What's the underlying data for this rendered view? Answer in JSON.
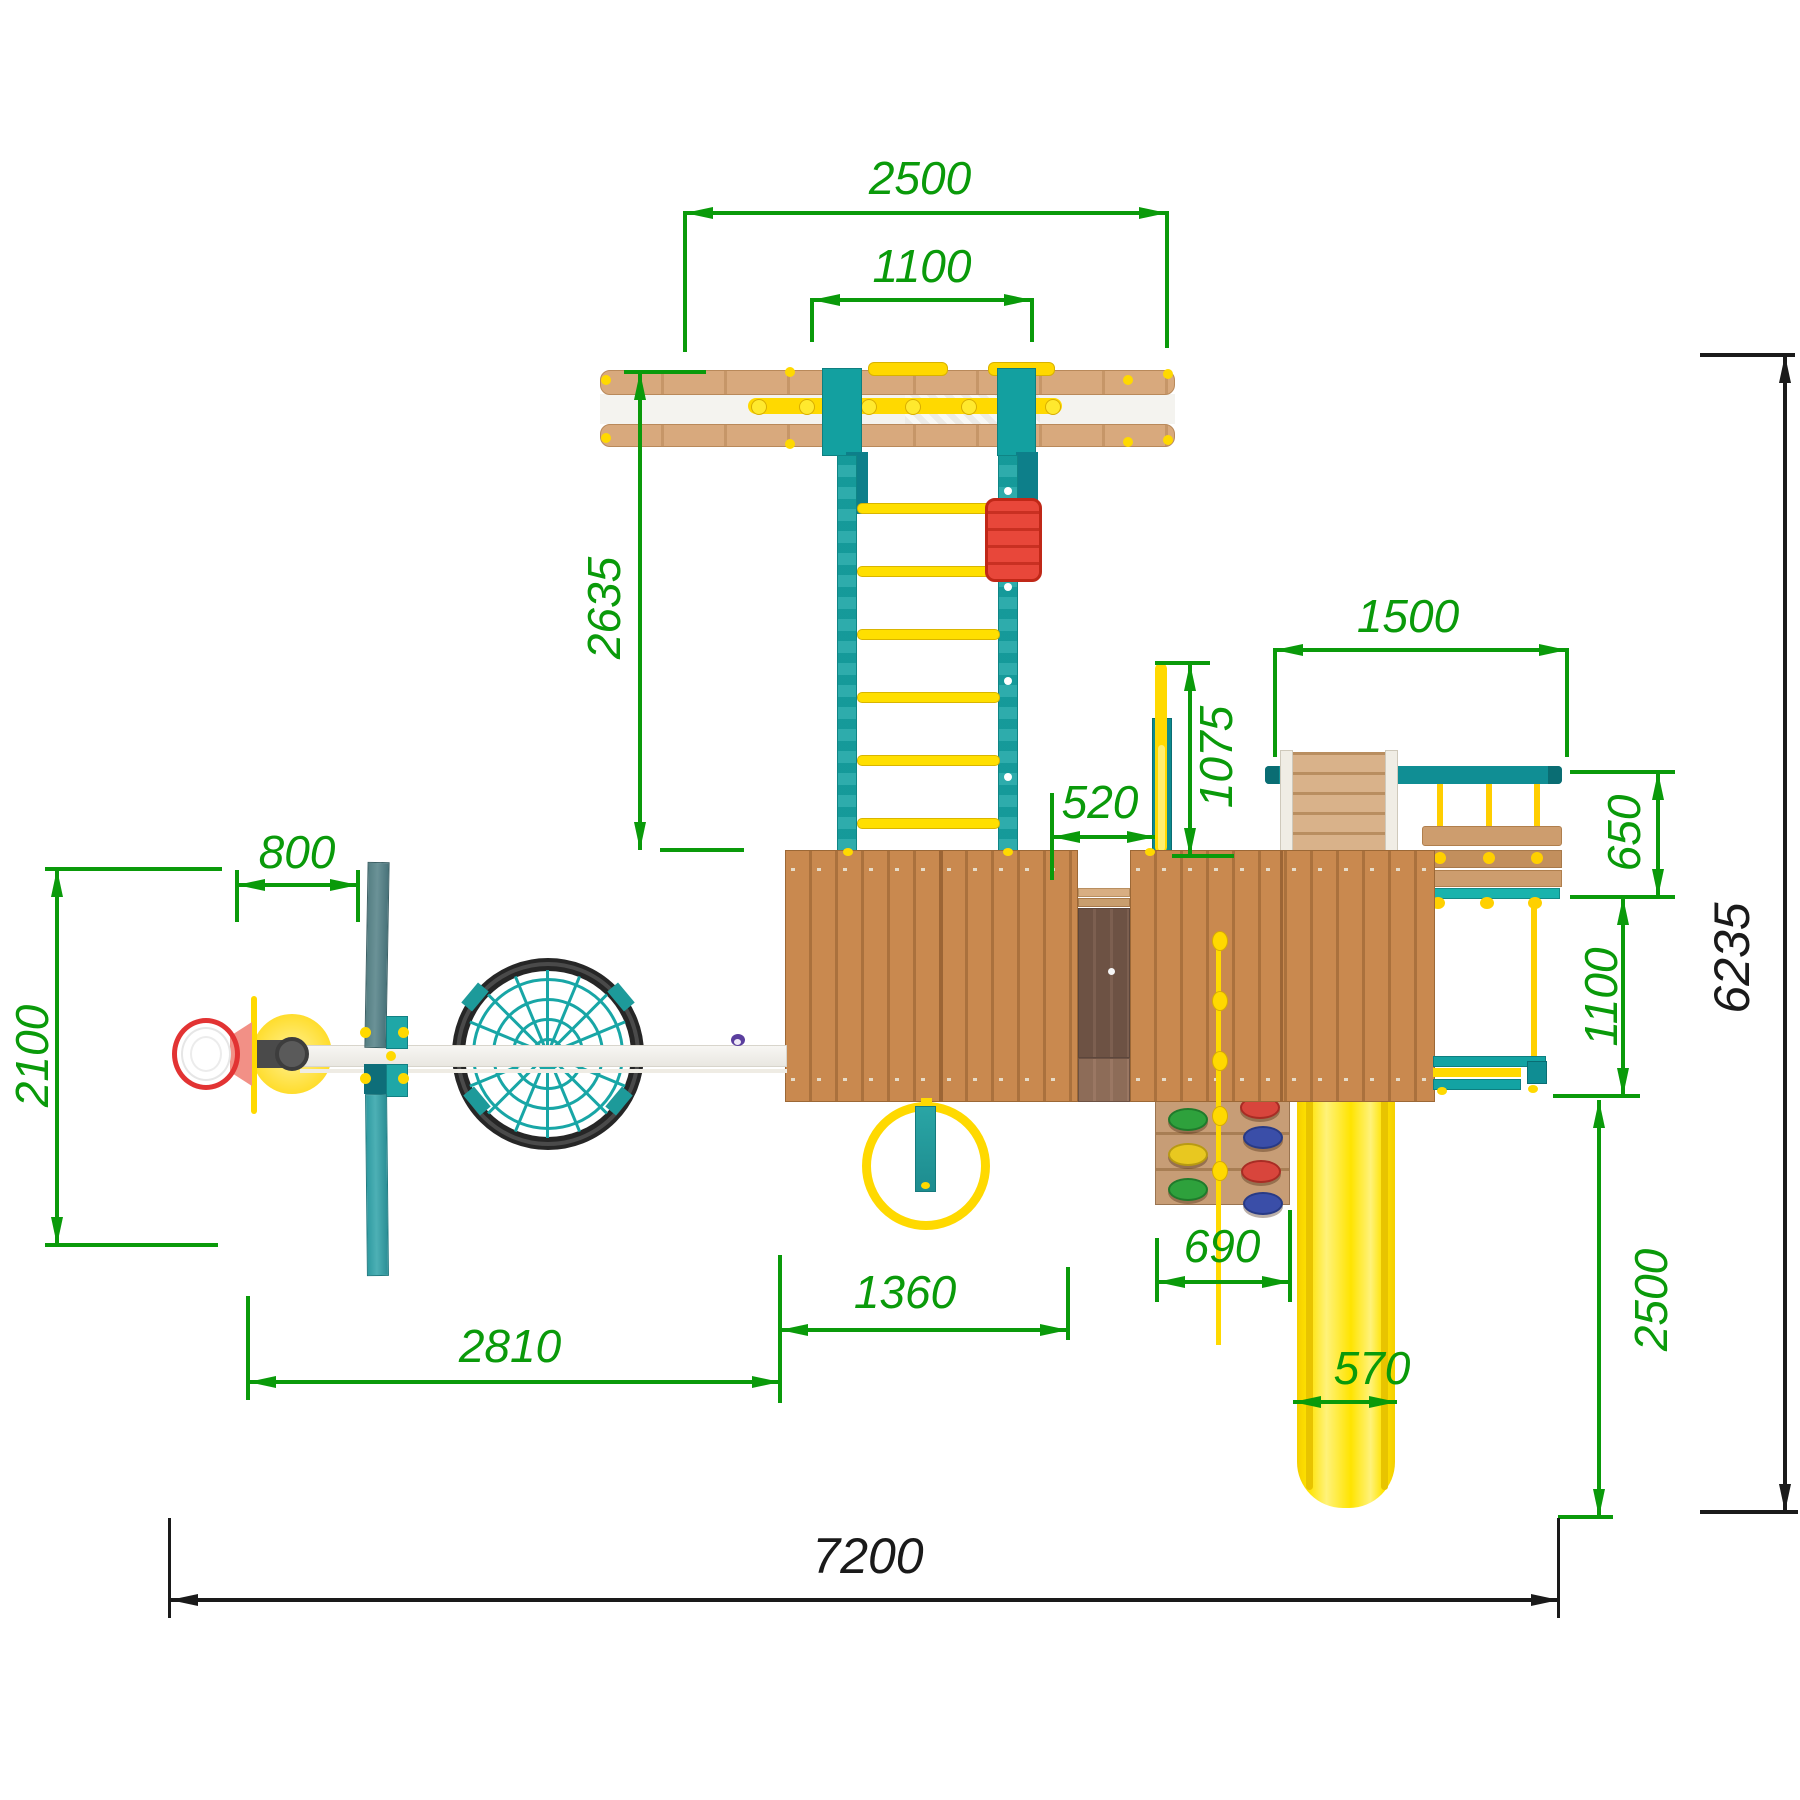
{
  "drawing": {
    "kind": "playground-top-view-plan",
    "units": "mm",
    "detail_dimension_color": "#0a9a0a",
    "overall_dimension_color": "#1a1a1a",
    "dimensions": {
      "top_beam_length": {
        "value": "2500"
      },
      "monkey_bar_span": {
        "value": "1100"
      },
      "ladder_length": {
        "value": "2635"
      },
      "basketball_offset": {
        "value": "800"
      },
      "left_zone_depth": {
        "value": "2100"
      },
      "swing_beam_span": {
        "value": "2810"
      },
      "ring_swing_span": {
        "value": "1360"
      },
      "bridge_gap": {
        "value": "520"
      },
      "pole_offset": {
        "value": "1075"
      },
      "right_beam_length": {
        "value": "1500"
      },
      "bench_depth": {
        "value": "650"
      },
      "tower_depth": {
        "value": "1100"
      },
      "slide_run_depth": {
        "value": "2500"
      },
      "climb_wall_width": {
        "value": "690"
      },
      "slide_width": {
        "value": "570"
      },
      "total_depth": {
        "value": "6235"
      },
      "total_width": {
        "value": "7200"
      }
    },
    "palette": {
      "wood_roof": "#c9894f",
      "wood_dark_bridge": "#6d5244",
      "teal": "#13a0a0",
      "teal_dark": "#0e7f80",
      "yellow": "#ffd900",
      "red": "#e23333",
      "white_beam": "#f4f3ef"
    }
  }
}
